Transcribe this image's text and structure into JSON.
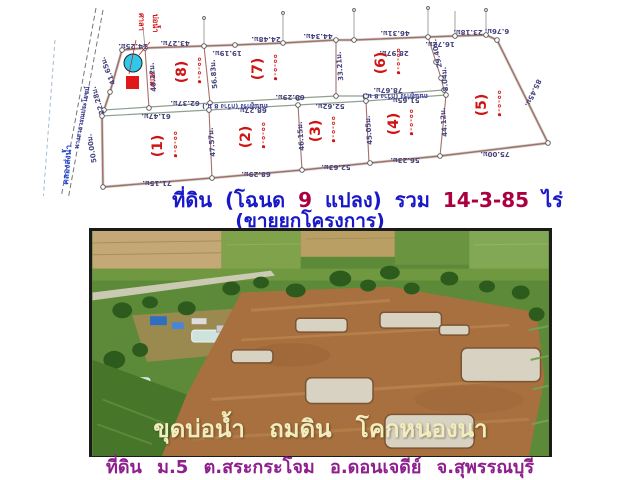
{
  "colors": {
    "title_blue": "#1818c8",
    "title_maroon": "#aa0040",
    "footer_purple": "#8e1f8e",
    "overlay_cream": "#f2edbe",
    "plot_number_red": "#cf1414",
    "pond_blue": "#30c8e8",
    "building_red": "#e01818"
  },
  "title": {
    "part1": "ที่ดิน (โฉนด",
    "plots_count": "9",
    "part2": "แปลง) รวม",
    "area_total": "14-3-85",
    "part3": "ไร่",
    "line2": "(ขายยกโครงการ)"
  },
  "survey": {
    "canal_label": "คลองส่งน้ำ",
    "road_left_label": "ทางสาธารณประโยชน์",
    "road_mid_label": "ถนนลูกรัง (กว้าง 8 ม.)",
    "road_mid_label2": "ถนนลูกรัง (กว้าง 8 ม.)",
    "pond_label": "บ่อน้ำ",
    "pavilion_label": "ศาลา",
    "pavilion_label_inner": "ศาลา",
    "plots": [
      {
        "no": "(1)",
        "area": "๑-๐-๐๐",
        "x": 162,
        "y": 146
      },
      {
        "no": "(2)",
        "area": "๑-๐-๐๐",
        "x": 250,
        "y": 137
      },
      {
        "no": "(3)",
        "area": "๑-๐-๐๐",
        "x": 320,
        "y": 131
      },
      {
        "no": "(4)",
        "area": "๑-๐-๐๐",
        "x": 398,
        "y": 124
      },
      {
        "no": "(5)",
        "area": "๑-๐-๐๐",
        "x": 486,
        "y": 105
      },
      {
        "no": "(6)",
        "area": "๑-๐-๐๐",
        "x": 385,
        "y": 63
      },
      {
        "no": "(7)",
        "area": "๑-๐-๐๐",
        "x": 262,
        "y": 69
      },
      {
        "no": "(8)",
        "area": "๑-๐-๐๐",
        "x": 186,
        "y": 72
      }
    ],
    "dims": [
      {
        "t": "14.25ม.",
        "x": 133,
        "y": 44,
        "r": 180
      },
      {
        "t": "43.27ม.",
        "x": 175,
        "y": 41,
        "r": 180
      },
      {
        "t": "19.19ม.",
        "x": 227,
        "y": 51,
        "r": 180
      },
      {
        "t": "24.48ม.",
        "x": 266,
        "y": 37,
        "r": 180
      },
      {
        "t": "44.34ม.",
        "x": 318,
        "y": 34,
        "r": 180
      },
      {
        "t": "46.31ม.",
        "x": 395,
        "y": 31,
        "r": 180
      },
      {
        "t": "16.72ม.",
        "x": 440,
        "y": 42,
        "r": 180
      },
      {
        "t": "23.18ม.",
        "x": 468,
        "y": 30,
        "r": 180
      },
      {
        "t": "6.76ม.",
        "x": 497,
        "y": 29,
        "r": 180
      },
      {
        "t": "85.45ม.",
        "x": 531,
        "y": 92,
        "r": 115
      },
      {
        "t": "75.00ม.",
        "x": 495,
        "y": 152,
        "r": 180
      },
      {
        "t": "71.15ม.",
        "x": 157,
        "y": 181,
        "r": 180
      },
      {
        "t": "68.29ม.",
        "x": 256,
        "y": 172,
        "r": 180
      },
      {
        "t": "52.63ม.",
        "x": 336,
        "y": 165,
        "r": 180
      },
      {
        "t": "56.23ม.",
        "x": 405,
        "y": 158,
        "r": 180
      },
      {
        "t": "61.47ม.",
        "x": 156,
        "y": 114,
        "r": 180
      },
      {
        "t": "68.27ม.",
        "x": 252,
        "y": 108,
        "r": 180
      },
      {
        "t": "52.62ม.",
        "x": 330,
        "y": 104,
        "r": 180
      },
      {
        "t": "51.65ม.",
        "x": 405,
        "y": 98,
        "r": 180
      },
      {
        "t": "62.37ม.",
        "x": 185,
        "y": 101,
        "r": 180
      },
      {
        "t": "68.29ม.",
        "x": 290,
        "y": 95,
        "r": 180
      },
      {
        "t": "78.67ม.",
        "x": 388,
        "y": 88,
        "r": 180
      },
      {
        "t": "28.97ม.",
        "x": 394,
        "y": 51,
        "r": 180
      },
      {
        "t": "40.12ม.",
        "x": 155,
        "y": 77,
        "r": 265
      },
      {
        "t": "56.83ม.",
        "x": 216,
        "y": 74,
        "r": 265
      },
      {
        "t": "33.21ม.",
        "x": 342,
        "y": 66,
        "r": 265
      },
      {
        "t": "29.40ม.",
        "x": 439,
        "y": 53,
        "r": 258
      },
      {
        "t": "8.04ม.",
        "x": 447,
        "y": 79,
        "r": 265
      },
      {
        "t": "47.57ม.",
        "x": 214,
        "y": 142,
        "r": 265
      },
      {
        "t": "46.15ม.",
        "x": 303,
        "y": 136,
        "r": 265
      },
      {
        "t": "45.05ม.",
        "x": 371,
        "y": 130,
        "r": 265
      },
      {
        "t": "44.12ม.",
        "x": 446,
        "y": 122,
        "r": 265
      },
      {
        "t": "41.65ม.",
        "x": 110,
        "y": 70,
        "r": 248
      },
      {
        "t": "22.28ม.",
        "x": 100,
        "y": 100,
        "r": 252
      },
      {
        "t": "50.00ม.",
        "x": 94,
        "y": 148,
        "r": 260
      }
    ]
  },
  "photo": {
    "overlay_text": "ขุดบ่อน้ำ ถมดิน โคกหนองนา"
  },
  "footer": {
    "location": "ที่ดิน ม.5 ต.สระกระโจม อ.ดอนเจดีย์ จ.สุพรรณบุรี"
  }
}
